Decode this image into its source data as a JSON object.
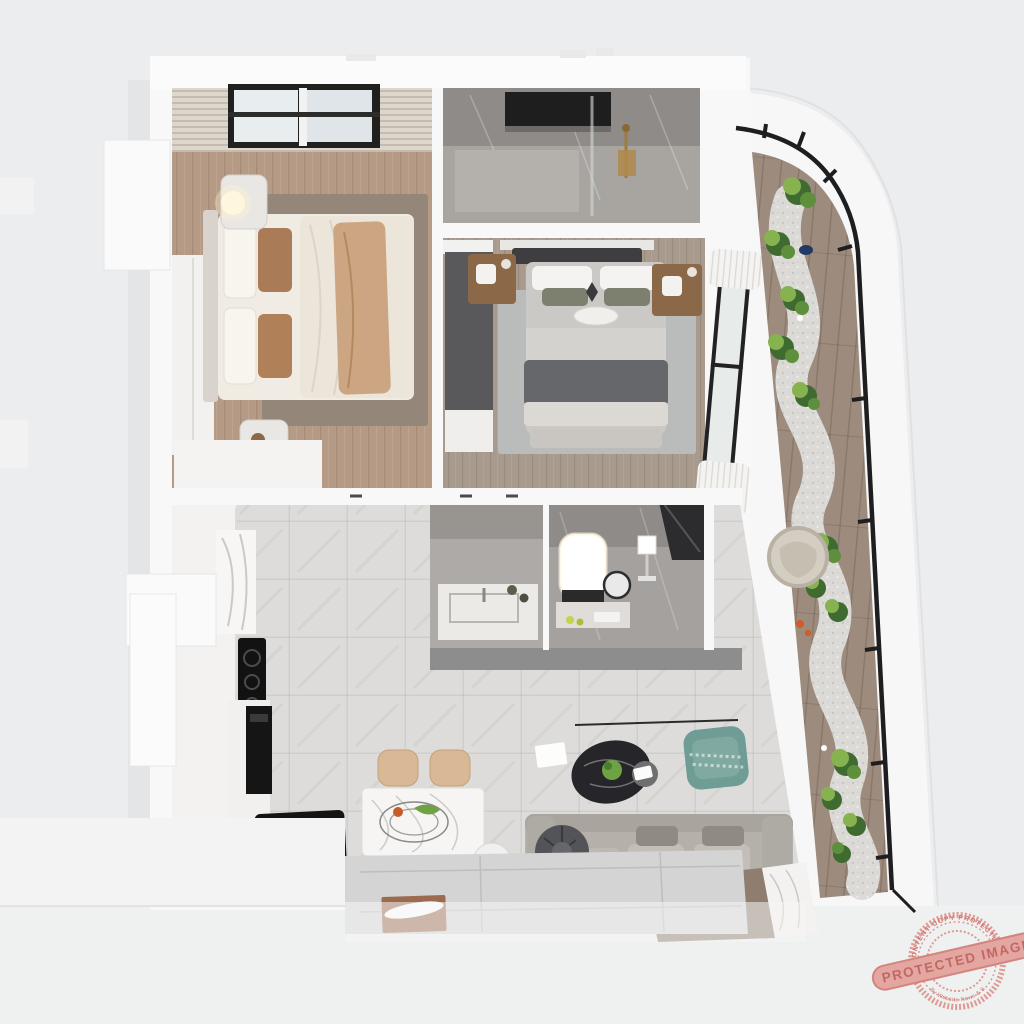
{
  "scene": {
    "type": "3d-apartment-floor-plan-render",
    "rooms": [
      "bedroom-1",
      "ensuite-shower-room",
      "bedroom-2",
      "balcony-garden",
      "kitchen",
      "dining-area",
      "washbasin-nook",
      "vanity-bathroom",
      "living-room",
      "entry-platform"
    ],
    "palette": {
      "background": "#ecedee",
      "wall_white": "#f8f8f9",
      "wood_warm": "#b59b86",
      "wood_gray": "#a89b8e",
      "deck_wood": "#9d8c7d",
      "rug_taupe": "#8e8071",
      "rug_gray": "#b9bcba",
      "rug_living": "#d4d4d5",
      "marble_floor": "#dedcda",
      "marble_dark_wall": "#918d8a",
      "glazing_frame": "#1e1e20",
      "plant_green": "#86b24f",
      "plant_dark": "#3f6b31",
      "accent_teal": "#6f9c94",
      "accent_brown": "#a97c57",
      "appliance_black": "#141414",
      "pebble": "#dbdad7",
      "watermark_red": "#d97b74"
    }
  },
  "watermark": {
    "banner": "PROTECTED IMAGE",
    "arc_top": "CONTENT COPY PROTECTION",
    "arc_bottom": "By Website News & SEO Tools"
  }
}
